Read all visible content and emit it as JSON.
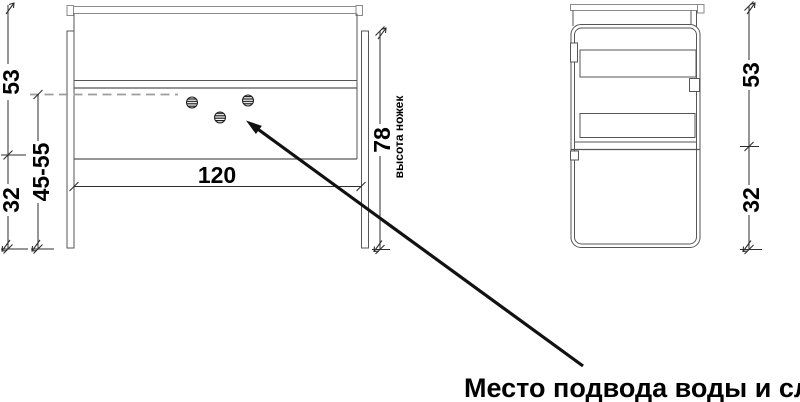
{
  "drawing": {
    "type": "cabinet-orthographic-views",
    "callout": {
      "text": "Место подвода воды и слив"
    },
    "views": {
      "front": {
        "dim_upper_height": "53",
        "dim_adjustable_height": "45-55",
        "dim_leg_height": "32",
        "dim_width": "120",
        "dim_height_with_legs": "78",
        "height_note": "высота ножек"
      },
      "side": {
        "dim_upper_height": "53",
        "dim_leg_height": "32"
      }
    },
    "holes": {
      "count": 3
    },
    "colors": {
      "outline": "#565656",
      "light_outline": "#8a8a8a",
      "dimension": "#2e2e2e",
      "dash": "#9c9c9c",
      "text": "#000000",
      "background": "#ffffff"
    }
  }
}
